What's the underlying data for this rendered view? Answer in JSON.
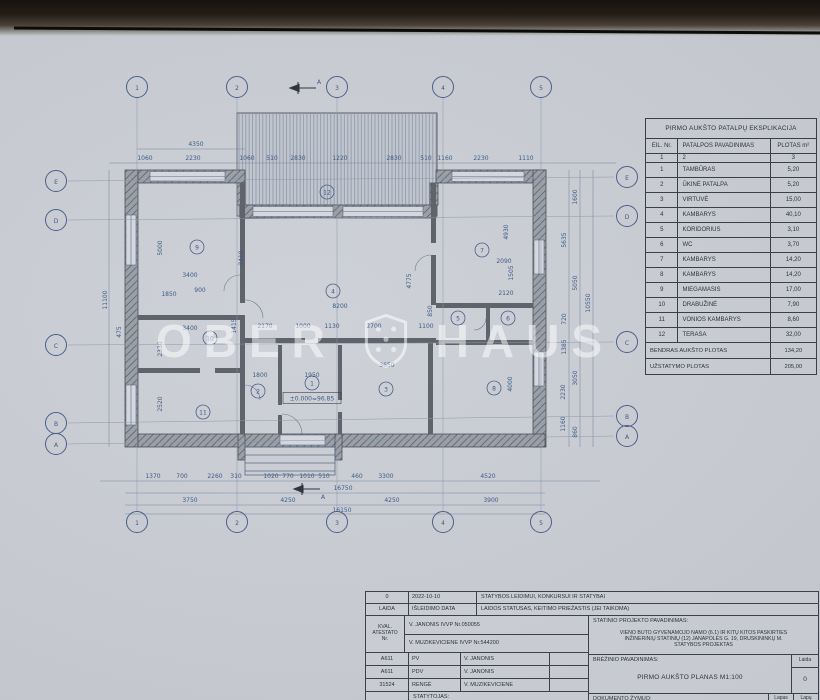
{
  "watermark": {
    "left": "OBER",
    "right": "HAUS"
  },
  "explication_table": {
    "title": "PIRMO AUKŠTO PATALPŲ EKSPLIKACIJA",
    "columns": [
      "EIL. Nr.",
      "PATALPOS PAVADINIMAS",
      "PLOTAS m²"
    ],
    "column_numbers": [
      "1",
      "2",
      "3"
    ],
    "rows": [
      [
        "1",
        "TAMBŪRAS",
        "5,20"
      ],
      [
        "2",
        "ŪKINĖ PATALPA",
        "5,20"
      ],
      [
        "3",
        "VIRTUVĖ",
        "15,00"
      ],
      [
        "4",
        "KAMBARYS",
        "40,10"
      ],
      [
        "5",
        "KORIDORIUS",
        "3,10"
      ],
      [
        "6",
        "WC",
        "3,70"
      ],
      [
        "7",
        "KAMBARYS",
        "14,20"
      ],
      [
        "8",
        "KAMBARYS",
        "14,20"
      ],
      [
        "9",
        "MIEGAMASIS",
        "17,00"
      ],
      [
        "10",
        "DRABUŽINĖ",
        "7,90"
      ],
      [
        "11",
        "VONIOS KAMBARYS",
        "8,60"
      ],
      [
        "12",
        "TERASA",
        "32,00"
      ]
    ],
    "totals": [
      [
        "BENDRAS AUKŠTO PLOTAS",
        "134,20"
      ],
      [
        "UŽSTATYMO PLOTAS",
        "205,00"
      ]
    ]
  },
  "title_block": {
    "revision_row": {
      "laida": "0",
      "date": "2022-10-10",
      "status": "STATYBOS LEIDIMUI, KONKURSUI IR STATYBAI"
    },
    "header_row": {
      "laida": "LAIDA",
      "date": "IŠLEIDIMO DATA",
      "status": "LAIDOS STATUSAS, KEITIMO PRIEŽASTIS (JEI TAIKOMA)"
    },
    "kval_label_lines": [
      "KVAL.",
      "ATESTATO",
      "Nr."
    ],
    "certificates": [
      "V. JANONIS IVVP Nr.050055",
      "V. MUZIKEVICIENE IVVP Nr.544200"
    ],
    "people": [
      {
        "no": "A611",
        "role": "PV",
        "name": "V. JANONIS"
      },
      {
        "no": "A611",
        "role": "PDV",
        "name": "V. JANONIS"
      },
      {
        "no": "31524",
        "role": "RENGĖ",
        "name": "V. MUZIKEVICIENE"
      }
    ],
    "statytojas_label": "STATYTOJAS:",
    "project_label": "STATINIO PROJEKTO PAVADINIMAS:",
    "project_name_lines": [
      "VIENO BUTO GYVENAMOJO NAMO (6.1) IR KITŲ KITOS PASKIRTIES",
      "INŽINERINIŲ STATINIŲ (12) JANAPOLĖS G. 19, DRUSKININKŲ M.",
      "STATYBOS  PROJEKTAS"
    ],
    "drawing_label": "BRĖŽINIO PAVADINIMAS:",
    "drawing_name": "PIRMO AUKŠTO PLANAS  M1:100",
    "laida_col_label": "Laida",
    "laida_value": "0",
    "doc_label": "DOKUMENTO ŽYMUO:",
    "lapas_label": "Lapas",
    "lapu_label": "Lapų"
  },
  "plan": {
    "section_label": "A",
    "level_mark": "±0.000=96.85",
    "colors": {
      "line": "#5a6a85",
      "dim_text": "#3e5a85",
      "wall": "#8d929a",
      "paper": "#c6cad0"
    },
    "grid": {
      "cols": [
        {
          "l": "1",
          "x": 137
        },
        {
          "l": "2",
          "x": 237
        },
        {
          "l": "3",
          "x": 337
        },
        {
          "l": "4",
          "x": 443
        },
        {
          "l": "5",
          "x": 541
        }
      ],
      "rows_left": [
        {
          "l": "E",
          "y": 181
        },
        {
          "l": "D",
          "y": 220
        },
        {
          "l": "C",
          "y": 345
        },
        {
          "l": "B",
          "y": 423
        },
        {
          "l": "A",
          "y": 444
        }
      ],
      "rows_right": [
        {
          "l": "E",
          "y": 177
        },
        {
          "l": "D",
          "y": 216
        },
        {
          "l": "C",
          "y": 342
        },
        {
          "l": "B",
          "y": 416
        },
        {
          "l": "A",
          "y": 436
        }
      ]
    },
    "rooms": [
      {
        "n": "1",
        "x": 312,
        "y": 383
      },
      {
        "n": "2",
        "x": 258,
        "y": 391
      },
      {
        "n": "3",
        "x": 386,
        "y": 389
      },
      {
        "n": "4",
        "x": 333,
        "y": 291
      },
      {
        "n": "5",
        "x": 458,
        "y": 318
      },
      {
        "n": "6",
        "x": 508,
        "y": 318
      },
      {
        "n": "7",
        "x": 482,
        "y": 250
      },
      {
        "n": "8",
        "x": 494,
        "y": 388
      },
      {
        "n": "9",
        "x": 197,
        "y": 247
      },
      {
        "n": "10",
        "x": 210,
        "y": 338
      },
      {
        "n": "11",
        "x": 203,
        "y": 412
      },
      {
        "n": "12",
        "x": 327,
        "y": 192
      }
    ],
    "dims": [
      {
        "t": "4350",
        "x": 196,
        "y": 146
      },
      {
        "t": "1060",
        "x": 145,
        "y": 160
      },
      {
        "t": "2230",
        "x": 193,
        "y": 160
      },
      {
        "t": "1060",
        "x": 247,
        "y": 160
      },
      {
        "t": "510",
        "x": 272,
        "y": 160
      },
      {
        "t": "2830",
        "x": 298,
        "y": 160
      },
      {
        "t": "1220",
        "x": 340,
        "y": 160
      },
      {
        "t": "2830",
        "x": 394,
        "y": 160
      },
      {
        "t": "510",
        "x": 426,
        "y": 160
      },
      {
        "t": "1160",
        "x": 445,
        "y": 160
      },
      {
        "t": "2230",
        "x": 481,
        "y": 160
      },
      {
        "t": "1110",
        "x": 526,
        "y": 160
      },
      {
        "t": "11100",
        "x": 107,
        "y": 300,
        "r": 1
      },
      {
        "t": "475",
        "x": 121,
        "y": 332,
        "r": 1
      },
      {
        "t": "5000",
        "x": 162,
        "y": 248,
        "r": 1
      },
      {
        "t": "2330",
        "x": 162,
        "y": 349,
        "r": 1
      },
      {
        "t": "2520",
        "x": 162,
        "y": 404,
        "r": 1
      },
      {
        "t": "3400",
        "x": 190,
        "y": 277
      },
      {
        "t": "1850",
        "x": 169,
        "y": 296
      },
      {
        "t": "900",
        "x": 200,
        "y": 292
      },
      {
        "t": "3400",
        "x": 190,
        "y": 330
      },
      {
        "t": "1415",
        "x": 236,
        "y": 326,
        "r": 1
      },
      {
        "t": "2410",
        "x": 243,
        "y": 258,
        "r": 1
      },
      {
        "t": "8200",
        "x": 340,
        "y": 308
      },
      {
        "t": "4775",
        "x": 411,
        "y": 281,
        "r": 1
      },
      {
        "t": "850",
        "x": 432,
        "y": 311,
        "r": 1
      },
      {
        "t": "2170",
        "x": 265,
        "y": 328
      },
      {
        "t": "1000",
        "x": 303,
        "y": 328
      },
      {
        "t": "1130",
        "x": 332,
        "y": 328
      },
      {
        "t": "2700",
        "x": 374,
        "y": 328
      },
      {
        "t": "1100",
        "x": 426,
        "y": 328
      },
      {
        "t": "1800",
        "x": 260,
        "y": 377
      },
      {
        "t": "1950",
        "x": 312,
        "y": 377
      },
      {
        "t": "3650",
        "x": 387,
        "y": 367
      },
      {
        "t": "2090",
        "x": 504,
        "y": 263
      },
      {
        "t": "2120",
        "x": 506,
        "y": 295
      },
      {
        "t": "1505",
        "x": 513,
        "y": 273,
        "r": 1
      },
      {
        "t": "4930",
        "x": 508,
        "y": 232,
        "r": 1
      },
      {
        "t": "4000",
        "x": 512,
        "y": 384,
        "r": 1
      },
      {
        "t": "1370",
        "x": 153,
        "y": 478
      },
      {
        "t": "700",
        "x": 182,
        "y": 478
      },
      {
        "t": "2260",
        "x": 215,
        "y": 478
      },
      {
        "t": "310",
        "x": 236,
        "y": 478
      },
      {
        "t": "1020",
        "x": 271,
        "y": 478
      },
      {
        "t": "770",
        "x": 288,
        "y": 478
      },
      {
        "t": "1010",
        "x": 307,
        "y": 478
      },
      {
        "t": "510",
        "x": 324,
        "y": 478
      },
      {
        "t": "460",
        "x": 357,
        "y": 478
      },
      {
        "t": "3300",
        "x": 386,
        "y": 478
      },
      {
        "t": "4520",
        "x": 488,
        "y": 478
      },
      {
        "t": "16750",
        "x": 343,
        "y": 490
      },
      {
        "t": "3750",
        "x": 190,
        "y": 502
      },
      {
        "t": "4250",
        "x": 288,
        "y": 502
      },
      {
        "t": "4250",
        "x": 392,
        "y": 502
      },
      {
        "t": "3900",
        "x": 491,
        "y": 502
      },
      {
        "t": "16150",
        "x": 342,
        "y": 512
      },
      {
        "t": "1600",
        "x": 577,
        "y": 197,
        "r": 1
      },
      {
        "t": "5635",
        "x": 566,
        "y": 240,
        "r": 1
      },
      {
        "t": "5050",
        "x": 577,
        "y": 283,
        "r": 1
      },
      {
        "t": "10550",
        "x": 590,
        "y": 303,
        "r": 1
      },
      {
        "t": "720",
        "x": 566,
        "y": 319,
        "r": 1
      },
      {
        "t": "1385",
        "x": 566,
        "y": 347,
        "r": 1
      },
      {
        "t": "3050",
        "x": 577,
        "y": 378,
        "r": 1
      },
      {
        "t": "2230",
        "x": 565,
        "y": 392,
        "r": 1
      },
      {
        "t": "1160",
        "x": 565,
        "y": 424,
        "r": 1
      },
      {
        "t": "860",
        "x": 577,
        "y": 432,
        "r": 1
      }
    ]
  }
}
